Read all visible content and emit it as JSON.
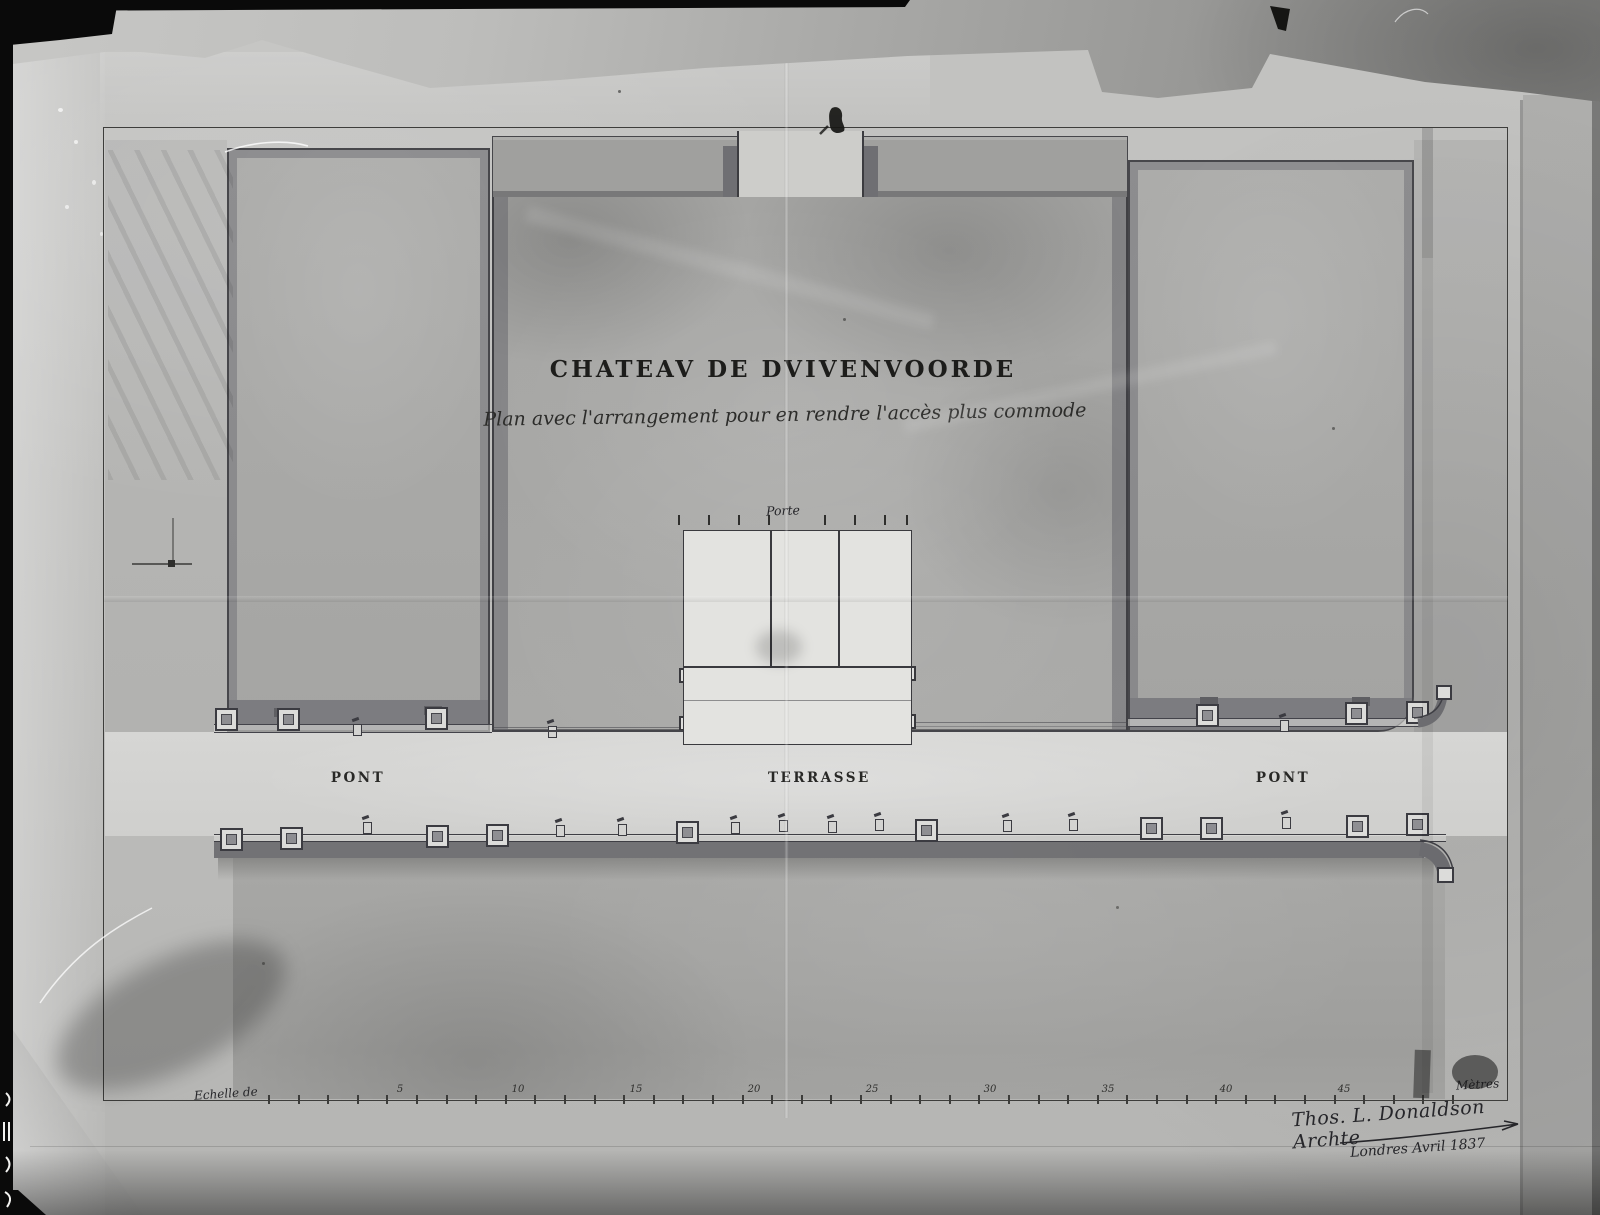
{
  "document": {
    "title": "CHATEAV DE DVIVENVOORDE",
    "subtitle": "Plan avec l'arrangement pour en rendre l'accès plus commode",
    "plan_labels": {
      "porte": "Porte",
      "pont_left": "PONT",
      "terrasse": "TERRASSE",
      "pont_right": "PONT"
    },
    "scale_bar": {
      "label": "Echelle de",
      "unit": "Mètres",
      "numbers": [
        "5",
        "10",
        "15",
        "20",
        "25",
        "30",
        "35",
        "40",
        "45"
      ]
    },
    "signature": {
      "line1": "Thos. L. Donaldson Archte",
      "line2": "Londres Avril 1837"
    }
  },
  "colors": {
    "photo_black": "#0a0a0a",
    "paper": "#c0c0be",
    "wash_block": "#a7a7a5",
    "wash_wall": "#6c6c70",
    "terrace": "#d5d5d3",
    "portico_white": "#e3e3e0",
    "ink": "#2b2b29"
  }
}
